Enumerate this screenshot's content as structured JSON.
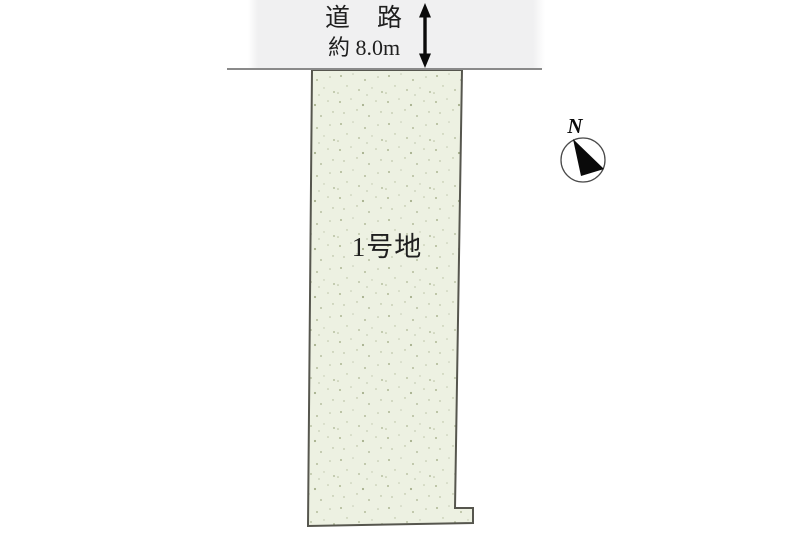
{
  "road": {
    "label": "道　路",
    "width_label": "約 8.0m"
  },
  "lot": {
    "label": "1号地"
  },
  "compass": {
    "north_label": "N"
  },
  "colors": {
    "background": "#ffffff",
    "road_band": "#f0f0f1",
    "road_line": "#8a8a8a",
    "lot_fill": "#edf1e2",
    "lot_speckle": "#aab492",
    "lot_border": "#56564e",
    "text": "#1f1f1f",
    "arrow": "#0a0a0a",
    "compass_needle": "#0a0a0a",
    "compass_ring": "#4a4a4a"
  }
}
